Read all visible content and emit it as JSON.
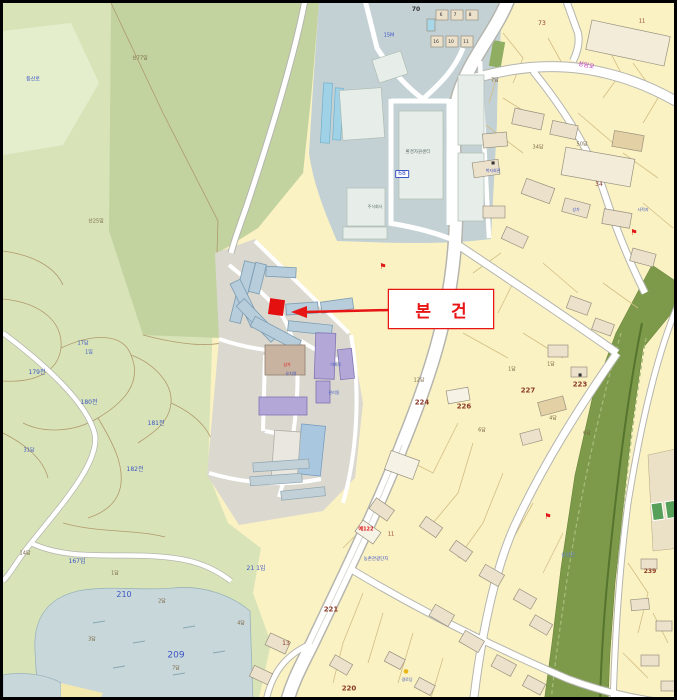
{
  "callout": {
    "label": "본 건"
  },
  "palette": {
    "accent_red": "#e81515",
    "parcel_yellow": "#fbf2c3",
    "forest_light": "#d8e4b8",
    "forest_dark": "#c2d3a0",
    "industrial_gray": "#c3d1d4",
    "apartment_blue": "#b7cddb",
    "apartment_purple": "#b2a7d6",
    "river_green": "#7d9a4a",
    "pond_blue": "#c8d7da",
    "road_white": "#ffffff",
    "label_blue": "#3d55c4",
    "label_brown": "#7c6847",
    "parcel_number_red": "#8a3a28",
    "street_name_magenta": "#c23ec2"
  },
  "map": {
    "labels": [
      {
        "t": "산77임",
        "x": 137,
        "y": 56,
        "c": "#7c6847",
        "s": 5
      },
      {
        "t": "산25임",
        "x": 93,
        "y": 219,
        "c": "#7c6847",
        "s": 5
      },
      {
        "t": "등산로",
        "x": 30,
        "y": 77,
        "c": "#3d55c4",
        "s": 5
      },
      {
        "t": "17답",
        "x": 80,
        "y": 341,
        "c": "#3d55c4",
        "s": 5
      },
      {
        "t": "1임",
        "x": 86,
        "y": 350,
        "c": "#3d55c4",
        "s": 5
      },
      {
        "t": "179전",
        "x": 34,
        "y": 370,
        "c": "#3d55c4",
        "s": 6
      },
      {
        "t": "180전",
        "x": 86,
        "y": 400,
        "c": "#3d55c4",
        "s": 6
      },
      {
        "t": "181전",
        "x": 153,
        "y": 421,
        "c": "#3d55c4",
        "s": 6
      },
      {
        "t": "182전",
        "x": 132,
        "y": 467,
        "c": "#3d55c4",
        "s": 6
      },
      {
        "t": "31답",
        "x": 26,
        "y": 448,
        "c": "#3d55c4",
        "s": 5
      },
      {
        "t": "14답",
        "x": 22,
        "y": 551,
        "c": "#7c6847",
        "s": 5
      },
      {
        "t": "167임",
        "x": 74,
        "y": 559,
        "c": "#3d55c4",
        "s": 6
      },
      {
        "t": "21 1임",
        "x": 253,
        "y": 566,
        "c": "#3d55c4",
        "s": 6
      },
      {
        "t": "210",
        "x": 121,
        "y": 592,
        "c": "#3d55c4",
        "s": 8
      },
      {
        "t": "209",
        "x": 173,
        "y": 653,
        "c": "#3d55c4",
        "s": 9
      },
      {
        "t": "1답",
        "x": 112,
        "y": 571,
        "c": "#7c6847",
        "s": 5
      },
      {
        "t": "2답",
        "x": 159,
        "y": 599,
        "c": "#7c6847",
        "s": 5
      },
      {
        "t": "3답",
        "x": 89,
        "y": 637,
        "c": "#7c6847",
        "s": 5
      },
      {
        "t": "7답",
        "x": 173,
        "y": 666,
        "c": "#7c6847",
        "s": 5
      },
      {
        "t": "4답",
        "x": 238,
        "y": 621,
        "c": "#7c6847",
        "s": 5
      },
      {
        "t": "70",
        "x": 413,
        "y": 7,
        "c": "#333333",
        "s": 6,
        "b": 1
      },
      {
        "t": "15M",
        "x": 386,
        "y": 33,
        "c": "#3d55c4",
        "s": 5
      },
      {
        "t": "환경자원센터",
        "x": 415,
        "y": 150,
        "c": "#5a6a6a",
        "s": 4.5
      },
      {
        "t": "68",
        "x": 399,
        "y": 171,
        "c": "#3d55c4",
        "s": 6,
        "box": 1
      },
      {
        "t": "주식회사",
        "x": 372,
        "y": 204,
        "c": "#5a6a6a",
        "s": 4
      },
      {
        "t": "6",
        "x": 438,
        "y": 13,
        "c": "#333333",
        "s": 4.5
      },
      {
        "t": "7",
        "x": 452,
        "y": 13,
        "c": "#333333",
        "s": 4.5
      },
      {
        "t": "8",
        "x": 467,
        "y": 13,
        "c": "#333333",
        "s": 4.5
      },
      {
        "t": "16",
        "x": 433,
        "y": 40,
        "c": "#333333",
        "s": 4.5
      },
      {
        "t": "10",
        "x": 448,
        "y": 40,
        "c": "#333333",
        "s": 4.5
      },
      {
        "t": "11",
        "x": 463,
        "y": 40,
        "c": "#333333",
        "s": 4.5
      },
      {
        "t": "73",
        "x": 539,
        "y": 21,
        "c": "#8a3a28",
        "s": 6
      },
      {
        "t": "11",
        "x": 639,
        "y": 19,
        "c": "#8a3a28",
        "s": 5
      },
      {
        "t": "성암로",
        "x": 583,
        "y": 63,
        "c": "#c23ec2",
        "s": 6,
        "r": 12
      },
      {
        "t": "34답",
        "x": 535,
        "y": 145,
        "c": "#7c6847",
        "s": 5
      },
      {
        "t": "50답",
        "x": 579,
        "y": 142,
        "c": "#7c6847",
        "s": 5
      },
      {
        "t": "7답",
        "x": 492,
        "y": 78,
        "c": "#7c6847",
        "s": 5
      },
      {
        "t": "34",
        "x": 596,
        "y": 182,
        "c": "#8a3a28",
        "s": 6
      },
      {
        "t": "복지회관",
        "x": 490,
        "y": 168,
        "c": "#3d55c4",
        "s": 4
      },
      {
        "t": "상가",
        "x": 573,
        "y": 207,
        "c": "#3d55c4",
        "s": 4
      },
      {
        "t": "사적지",
        "x": 640,
        "y": 207,
        "c": "#3d55c4",
        "s": 4
      },
      {
        "t": "1답",
        "x": 509,
        "y": 367,
        "c": "#7c6847",
        "s": 5
      },
      {
        "t": "12답",
        "x": 416,
        "y": 378,
        "c": "#7c6847",
        "s": 5
      },
      {
        "t": "224",
        "x": 419,
        "y": 400,
        "c": "#8a3a28",
        "s": 7,
        "b": 1
      },
      {
        "t": "226",
        "x": 461,
        "y": 404,
        "c": "#8a3a28",
        "s": 7,
        "b": 1
      },
      {
        "t": "227",
        "x": 525,
        "y": 388,
        "c": "#8a3a28",
        "s": 7,
        "b": 1
      },
      {
        "t": "223",
        "x": 577,
        "y": 382,
        "c": "#8a3a28",
        "s": 7,
        "b": 1
      },
      {
        "t": "6답",
        "x": 479,
        "y": 428,
        "c": "#7c6847",
        "s": 5
      },
      {
        "t": "6답",
        "x": 584,
        "y": 431,
        "c": "#7c6847",
        "s": 5
      },
      {
        "t": "1답",
        "x": 548,
        "y": 362,
        "c": "#7c6847",
        "s": 5
      },
      {
        "t": "4답",
        "x": 550,
        "y": 416,
        "c": "#7c6847",
        "s": 5
      },
      {
        "t": "성암천",
        "x": 565,
        "y": 553,
        "c": "#6a84c4",
        "s": 5
      },
      {
        "t": "농촌관광단지",
        "x": 373,
        "y": 557,
        "c": "#3d55c4",
        "s": 4.5
      },
      {
        "t": "예122",
        "x": 363,
        "y": 527,
        "c": "#e01818",
        "s": 5,
        "b": 1
      },
      {
        "t": "11",
        "x": 388,
        "y": 532,
        "c": "#8a3a28",
        "s": 5
      },
      {
        "t": "221",
        "x": 328,
        "y": 607,
        "c": "#8a3a28",
        "s": 7,
        "b": 1
      },
      {
        "t": "220",
        "x": 346,
        "y": 686,
        "c": "#8a3a28",
        "s": 7,
        "b": 1
      },
      {
        "t": "13",
        "x": 283,
        "y": 641,
        "c": "#8a3a28",
        "s": 6
      },
      {
        "t": "239",
        "x": 647,
        "y": 569,
        "c": "#8a3a28",
        "s": 6,
        "b": 1
      },
      {
        "t": "●",
        "x": 403,
        "y": 669,
        "c": "#e8b618",
        "s": 6
      },
      {
        "t": "경로당",
        "x": 404,
        "y": 677,
        "c": "#3d55c4",
        "s": 4
      },
      {
        "t": "상가",
        "x": 284,
        "y": 362,
        "c": "#e01818",
        "s": 4
      },
      {
        "t": "유치원",
        "x": 288,
        "y": 371,
        "c": "#3d55c4",
        "s": 4
      },
      {
        "t": "아파트",
        "x": 333,
        "y": 362,
        "c": "#3d55c4",
        "s": 4
      },
      {
        "t": "관리동",
        "x": 331,
        "y": 390,
        "c": "#3d55c4",
        "s": 4
      },
      {
        "t": "⚑",
        "x": 380,
        "y": 264,
        "c": "#e01818",
        "s": 8
      },
      {
        "t": "⚑",
        "x": 631,
        "y": 230,
        "c": "#e01818",
        "s": 8
      },
      {
        "t": "⚑",
        "x": 545,
        "y": 514,
        "c": "#e01818",
        "s": 8
      },
      {
        "t": "■",
        "x": 577,
        "y": 372,
        "c": "#333333",
        "s": 4
      },
      {
        "t": "■",
        "x": 490,
        "y": 160,
        "c": "#333333",
        "s": 4
      }
    ]
  }
}
